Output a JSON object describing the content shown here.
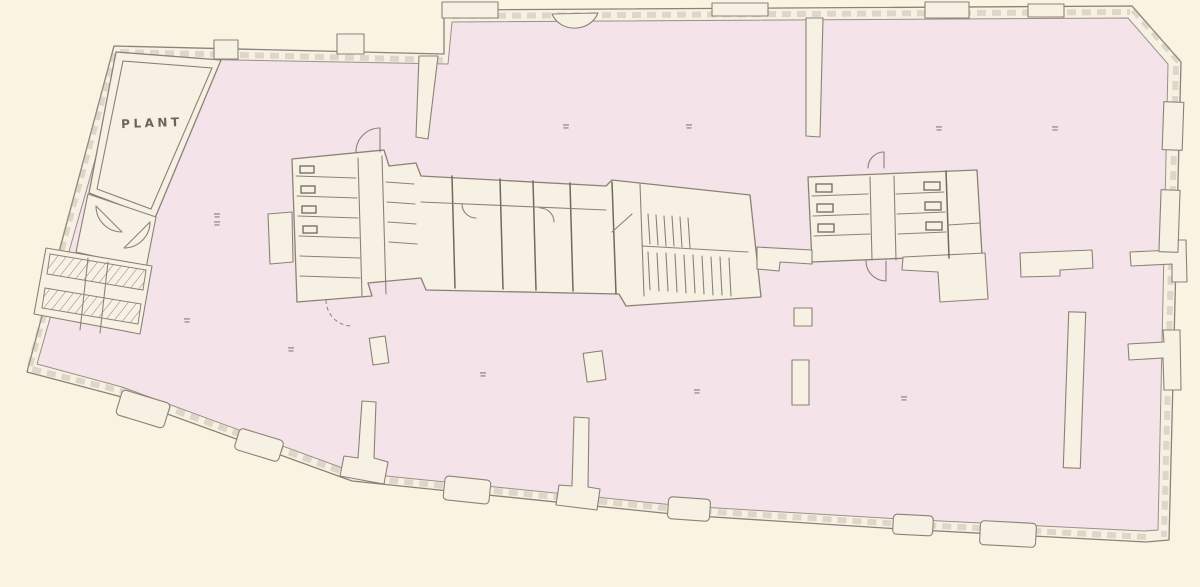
{
  "document": {
    "type": "architectural floor plan",
    "description": "Scanned single-floor building plan: large open floor tinted pink, plant room at north-west, two internal service cores (toilets, stairs, lifts), free-standing columns and wall fins, glazed perimeter walls with pilasters, chamfered north-east corner, splayed south-west edge."
  },
  "colors": {
    "background": "#fbf3e2",
    "floor": "#f4e3e9",
    "wall_fill": "#f7f1e4",
    "line": "#8b8277",
    "line_dark": "#6f6860",
    "label_text": "#6b6459"
  },
  "rooms": {
    "plant": {
      "label": "PLANT"
    },
    "open_floor": {
      "label": ""
    },
    "west_stair_core": {
      "label": ""
    },
    "central_core": {
      "label": ""
    },
    "east_core": {
      "label": ""
    }
  },
  "annotations": {
    "grid_marks": {
      "count": 11,
      "note": "tiny illegible grey reference marks scattered on floor"
    }
  }
}
